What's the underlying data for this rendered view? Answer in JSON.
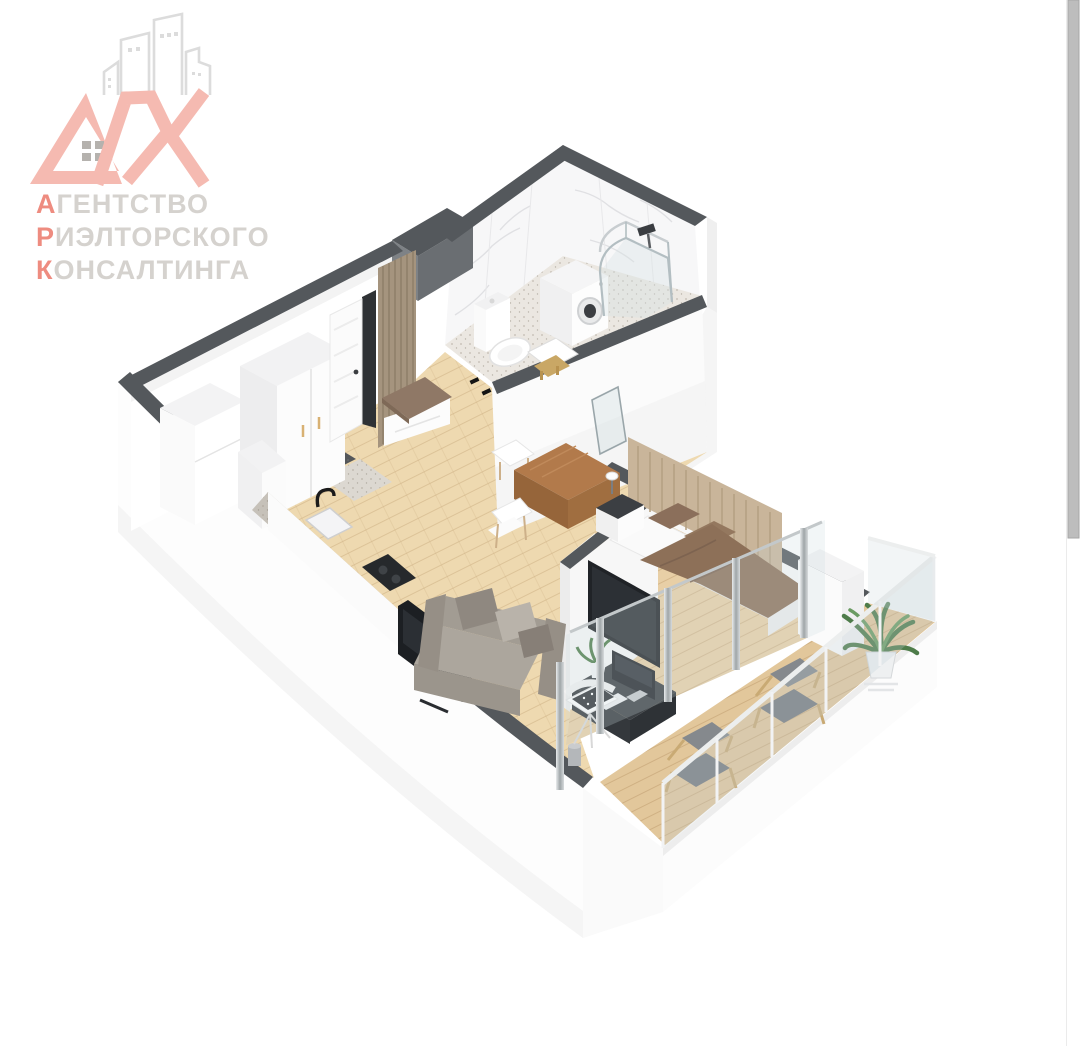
{
  "logo": {
    "mark_full": "АРК",
    "mark_rest": "РК",
    "line1_initial": "А",
    "line1_rest": "ГЕНТСТВО",
    "line2_initial": "Р",
    "line2_rest": "ИЭЛТОРСКОГО",
    "line3_initial": "К",
    "line3_rest": "ОНСАЛТИНГА",
    "colors": {
      "salmon": "#f5bab1",
      "accent_initial": "#ee8c80",
      "gray_text": "#d5d2ce",
      "building_outline": "#dcdcdc",
      "window_gray": "#b5b2ae"
    }
  },
  "scene": {
    "type": "3d-isometric-floor-plan-render",
    "rooms": [
      "bathroom",
      "hallway",
      "kitchen",
      "living-room",
      "bedroom",
      "balcony"
    ],
    "furniture_icons": [
      "shower-cabin-icon",
      "washing-machine-icon",
      "toilet-icon",
      "wardrobe-icon",
      "fridge-icon",
      "entrance-door-icon",
      "wood-slat-panel-icon",
      "bench-icon",
      "kitchen-counter-icon",
      "sink-icon",
      "faucet-icon",
      "cooktop-icon",
      "dining-table-icon",
      "dining-chair-icon",
      "sofa-icon",
      "tv-icon",
      "desk-icon",
      "computer-icon",
      "office-chair-icon",
      "bed-icon",
      "nightstand-icon",
      "table-lamp-icon",
      "lounge-chair-icon",
      "potted-plant-icon",
      "glass-railing-icon"
    ],
    "palette": {
      "wall_top": "#54585c",
      "wall_white": "#fdfdfd",
      "floor_wood": "#eed9b0",
      "floor_wood_dark": "#e4cba2",
      "bathroom_floor": "#ebe7e1",
      "sofa_gray": "#a7a198",
      "bed_blanket_brown": "#8d7058",
      "headboard_tan": "#c9b59a",
      "desk_dark": "#3d4145",
      "plant_green": "#4e7c4a"
    }
  },
  "scrollbar": {
    "present": true,
    "thumb_color": "#bdbdbd",
    "track_color": "#ffffff"
  }
}
